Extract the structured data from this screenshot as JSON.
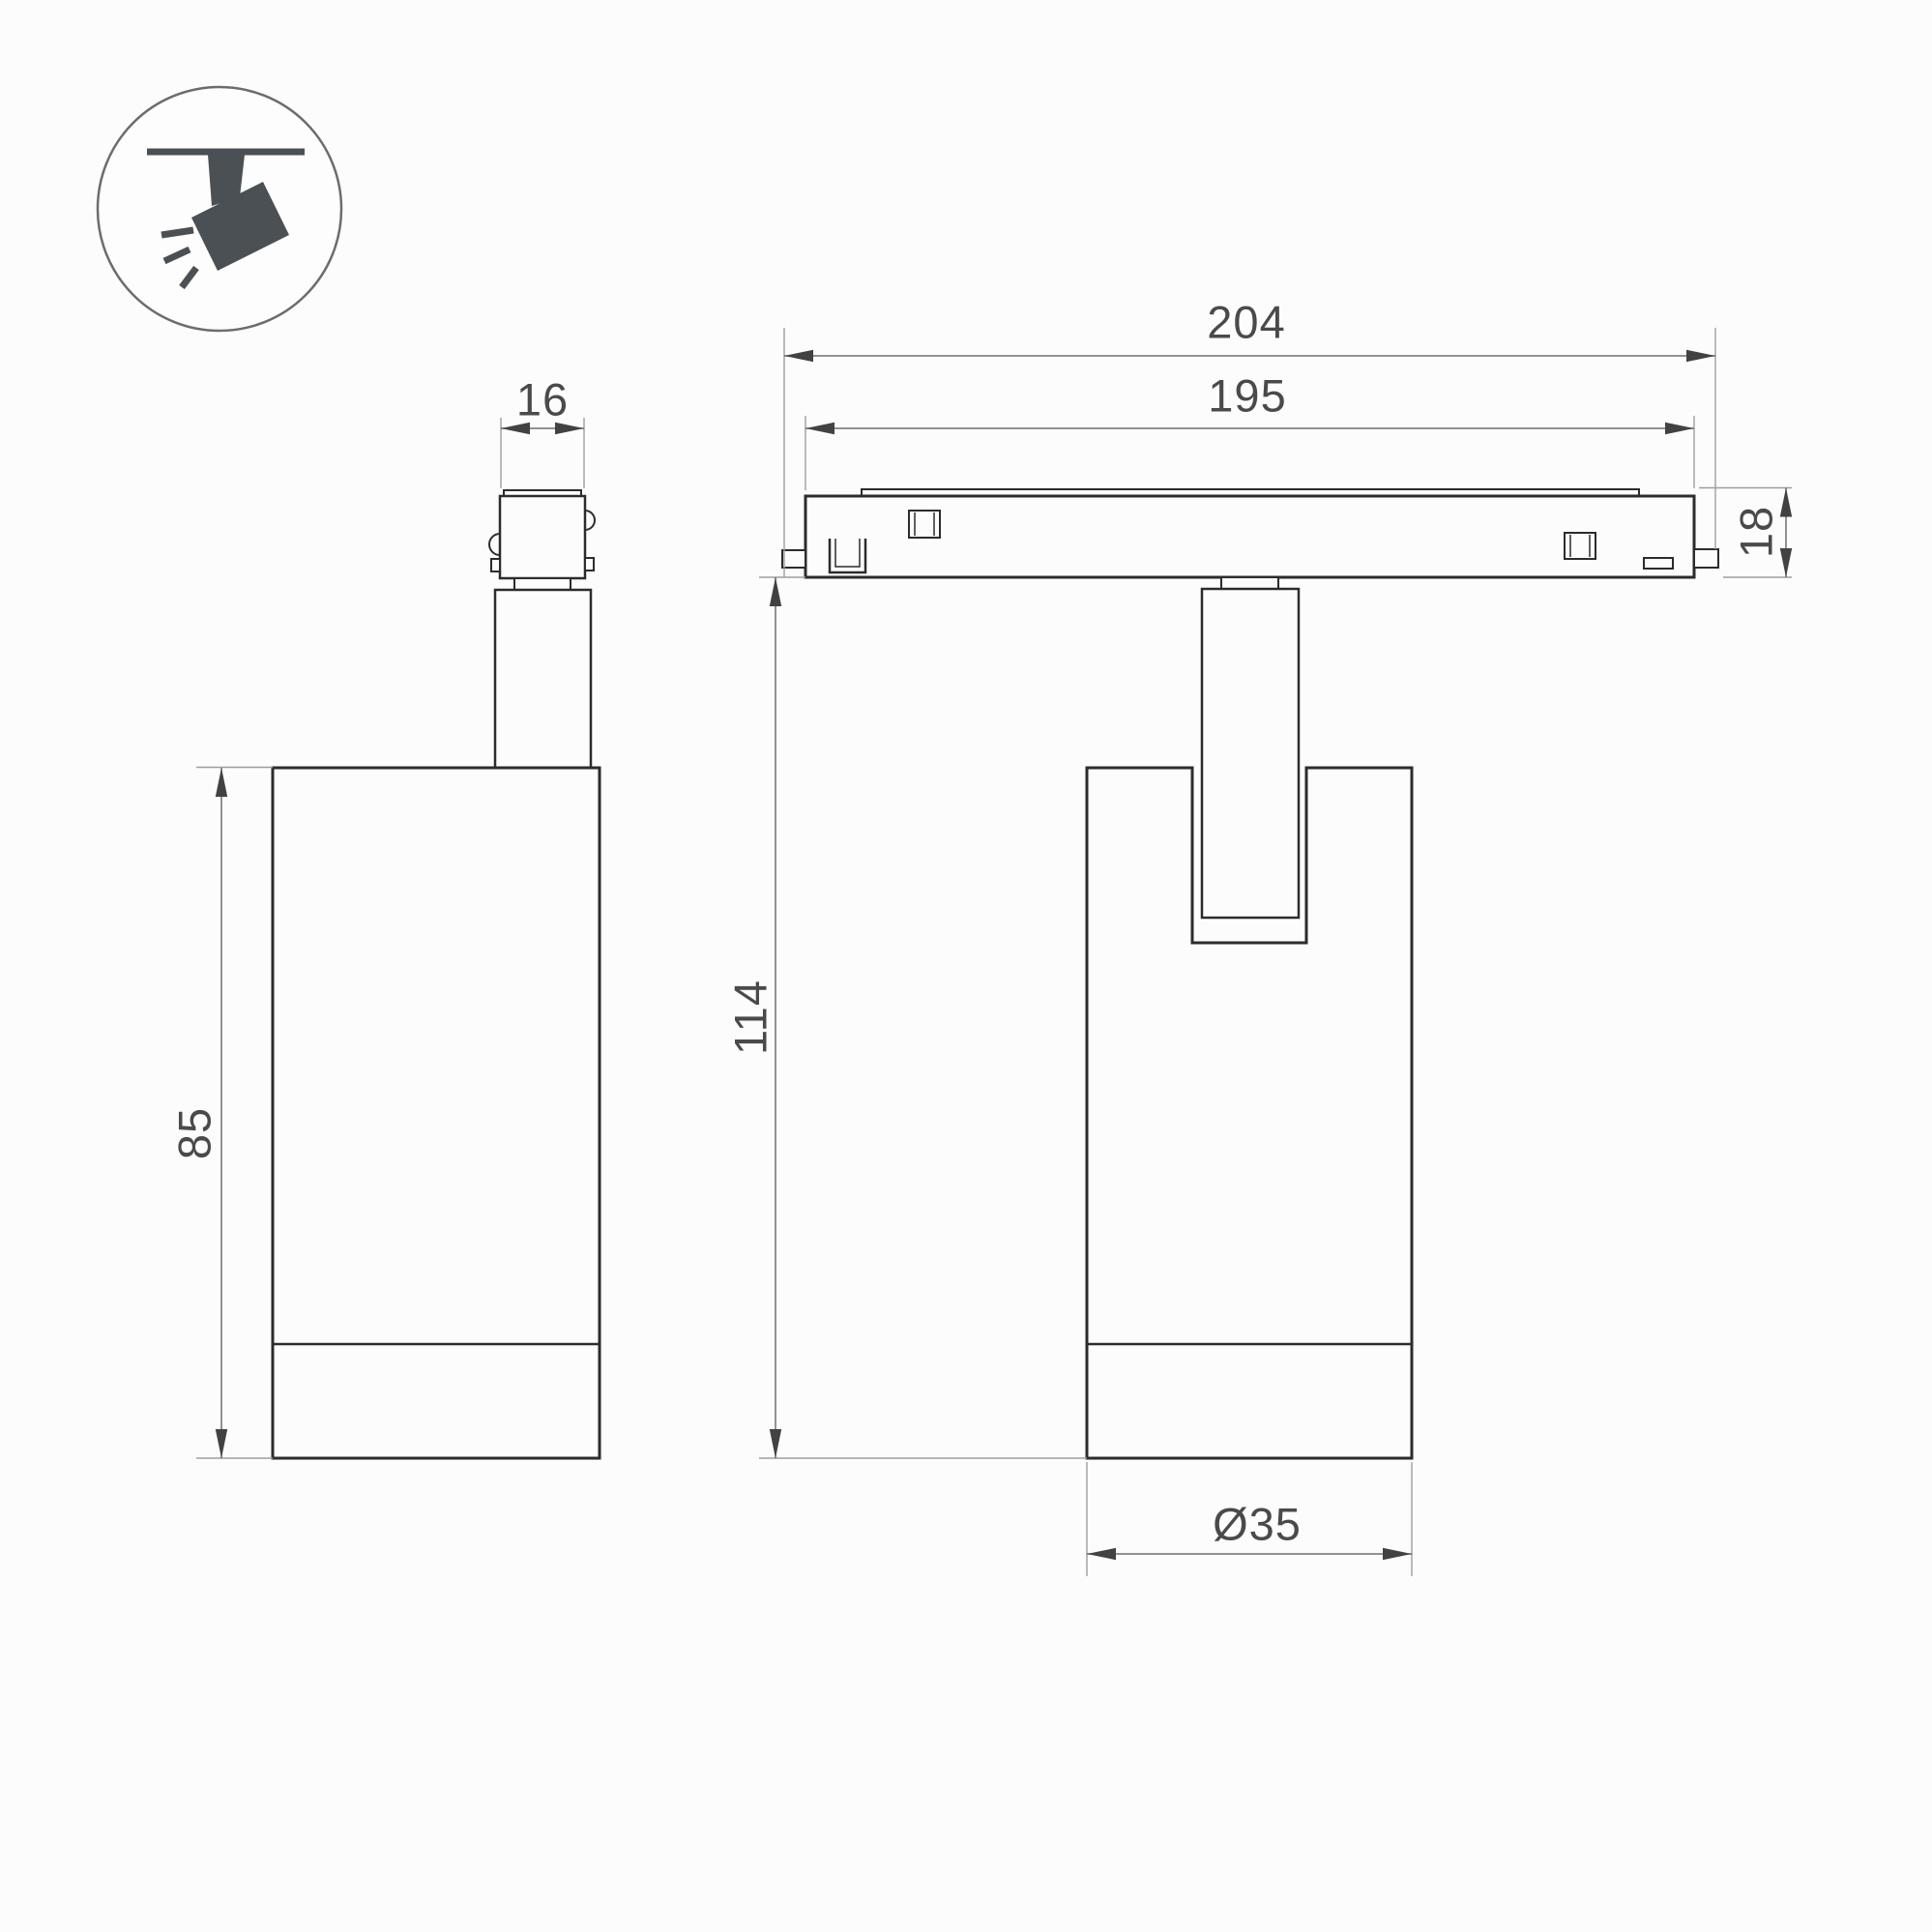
{
  "drawing": {
    "type": "technical-dimension-drawing",
    "subject": "magnetic track spotlight luminaire, side view and front view with dimensions"
  },
  "icon": {
    "name": "ceiling-track-spotlight-icon",
    "description": "spotlight hanging from ceiling track, tilted, emitting light rays"
  },
  "dimensions": {
    "adapter_width": "16",
    "track_overall_length": "204",
    "track_body_length": "195",
    "track_height": "18",
    "body_height": "85",
    "overall_height": "114",
    "body_diameter": "Ø35"
  },
  "colors": {
    "background": "#fcfcfc",
    "outline": "#2c2c2e",
    "dimension_line": "#6f6f71",
    "extension_line": "#9e9ea0",
    "arrow": "#424244",
    "text": "#4a4a4c",
    "icon_fill": "#4b5055"
  }
}
